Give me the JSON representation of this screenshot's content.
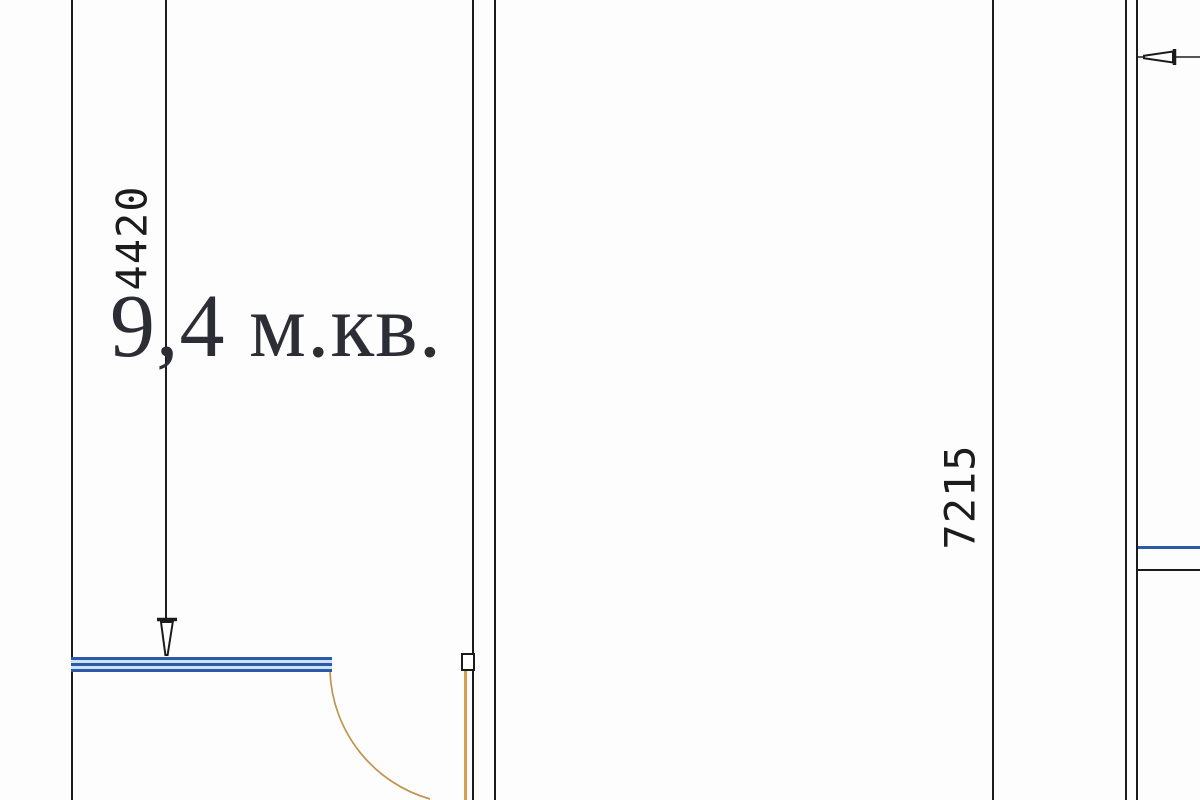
{
  "plan": {
    "room_area_label": "9,4 м.кв.",
    "dim_vertical_left": {
      "value": "4420",
      "orientation": "vertical"
    },
    "dim_vertical_middle": {
      "value": "7215",
      "orientation": "vertical"
    }
  },
  "colors": {
    "background": "#fdfdfd",
    "wall": "#1b1b1b",
    "dim_line": "#1c1c1c",
    "dim_text": "#1c1c1c",
    "area_text": "#2d2d35",
    "window_frame": "#2a5aa8",
    "window_fill": "#cfe2f4",
    "door": "#d4a050",
    "door_arc": "#c2934a"
  }
}
